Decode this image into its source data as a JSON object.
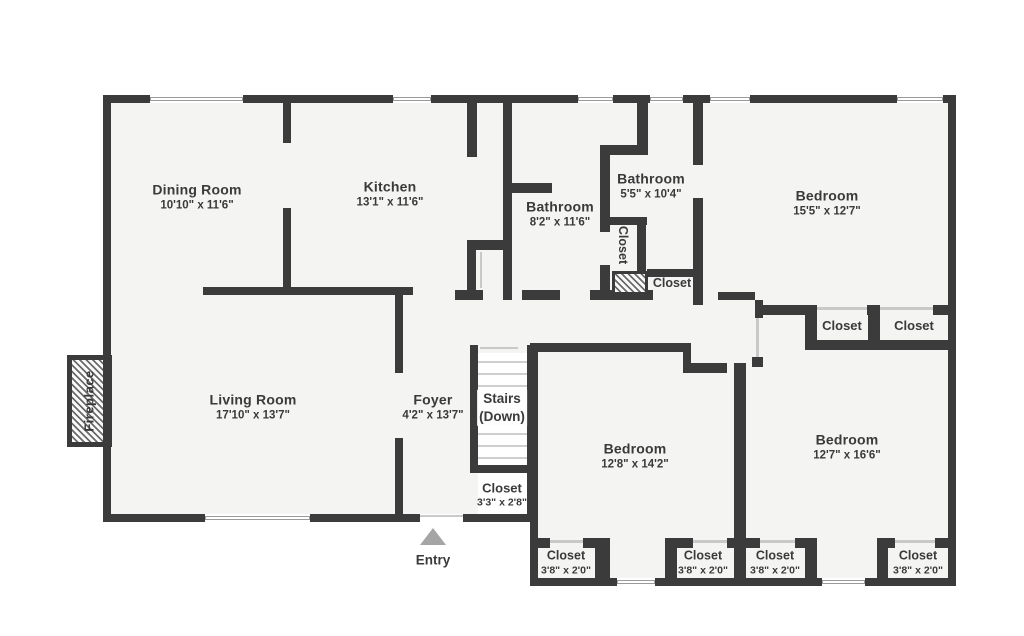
{
  "rooms": {
    "dining": {
      "name": "Dining Room",
      "dims": "10'10\" x 11'6\""
    },
    "kitchen": {
      "name": "Kitchen",
      "dims": "13'1\" x 11'6\""
    },
    "bathroom_main": {
      "name": "Bathroom",
      "dims": "8'2\" x 11'6\""
    },
    "bathroom_ensuite": {
      "name": "Bathroom",
      "dims": "5'5\" x 10'4\""
    },
    "bedroom_ne": {
      "name": "Bedroom",
      "dims": "15'5\" x 12'7\""
    },
    "living": {
      "name": "Living Room",
      "dims": "17'10\" x 13'7\""
    },
    "foyer": {
      "name": "Foyer",
      "dims": "4'2\" x 13'7\""
    },
    "bedroom_s": {
      "name": "Bedroom",
      "dims": "12'8\" x 14'2\""
    },
    "bedroom_se": {
      "name": "Bedroom",
      "dims": "12'7\" x 16'6\""
    }
  },
  "stairs": {
    "line1": "Stairs",
    "line2": "(Down)"
  },
  "closets": {
    "under_stairs": {
      "label": "Closet",
      "dims": "3'3\" x 2'8\""
    },
    "hall_vertical": {
      "label": "Closet"
    },
    "hall_small": {
      "label": "Closet"
    },
    "bedroom_ne_a": {
      "label": "Closet"
    },
    "bedroom_ne_b": {
      "label": "Closet"
    },
    "bottom": [
      {
        "label": "Closet",
        "dims": "3'8\" x 2'0\""
      },
      {
        "label": "Closet",
        "dims": "3'8\" x 2'0\""
      },
      {
        "label": "Closet",
        "dims": "3'8\" x 2'0\""
      },
      {
        "label": "Closet",
        "dims": "3'8\" x 2'0\""
      }
    ]
  },
  "annotations": {
    "fireplace": "Fireplace",
    "entry": "Entry"
  },
  "colors": {
    "wall": "#3b3b3b",
    "floor": "#f4f4f3",
    "text": "#3a3a3a"
  }
}
